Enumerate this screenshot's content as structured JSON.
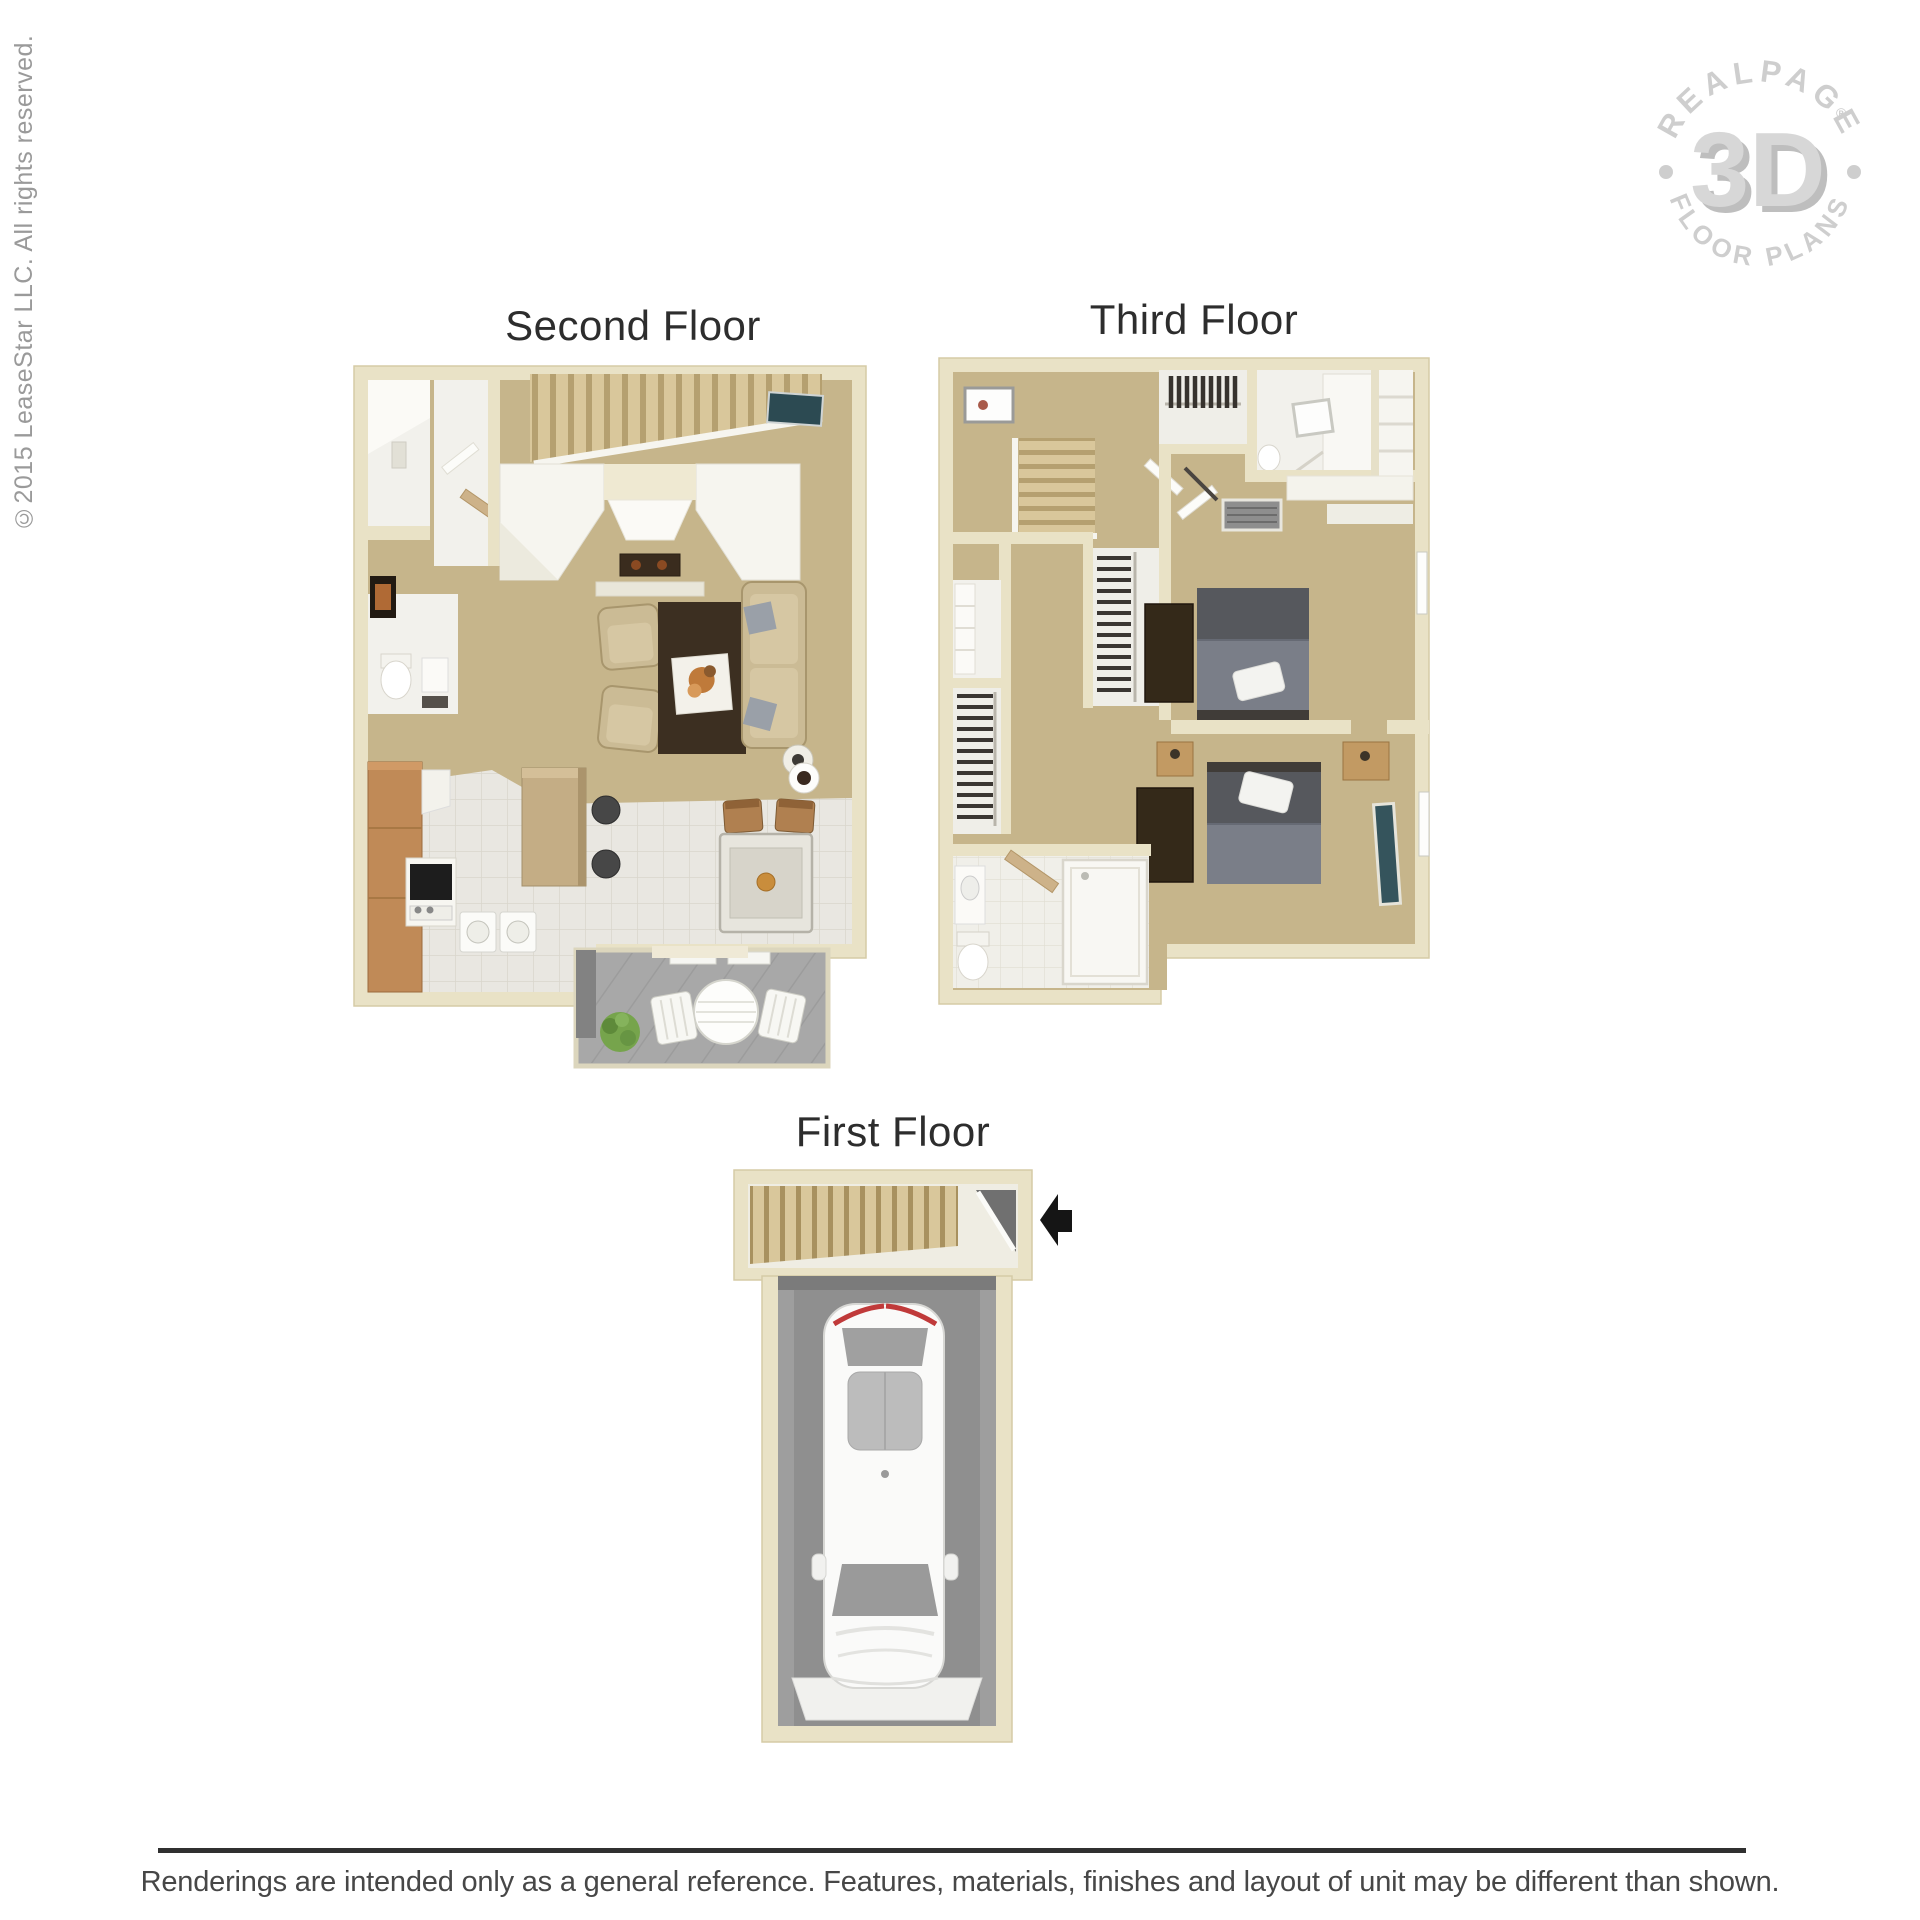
{
  "page": {
    "background": "#ffffff",
    "copyright": "©2015 LeaseStar LLC. All rights reserved.",
    "disclaimer": "Renderings are intended only as a general reference. Features, materials, finishes and layout of unit may be different than shown."
  },
  "watermark": {
    "arc_top": "REALPAGE",
    "arc_bottom": "FLOOR PLANS",
    "center": "3D",
    "registered_mark": "®"
  },
  "floors": [
    {
      "id": "second-floor",
      "label": "Second Floor"
    },
    {
      "id": "third-floor",
      "label": "Third Floor"
    },
    {
      "id": "first-floor",
      "label": "First Floor"
    }
  ],
  "colors": {
    "background": "#ffffff",
    "label_text": "#2d2d2d",
    "disclaimer_text": "#474747",
    "divider": "#303030",
    "copyright_text": "#9a9a9a",
    "logo_gray": "#c9c9c9",
    "wall_cream": "#e9e2c6",
    "wall_cream_shade": "#d5cba6",
    "floor_tan": "#c6b58b",
    "white_room": "#f2f1ec",
    "tile_white": "#e9e7e1",
    "wood_cabinet": "#c08a57",
    "island_wood": "#c4ad85",
    "sofa_beige": "#cbbb95",
    "rug_brown": "#3c2f21",
    "bed_gray": "#56585d",
    "blanket_gray": "#7a7e88",
    "dresser_brown": "#342919",
    "deck_gray": "#a8a8a8",
    "garage_gray": "#8f8f8f",
    "stair_wood": "#d9c79b",
    "tv_teal": "#2c4a52",
    "plant_green": "#76a44c",
    "arrow_black": "#151515",
    "tail_light_red": "#c03a3a"
  }
}
